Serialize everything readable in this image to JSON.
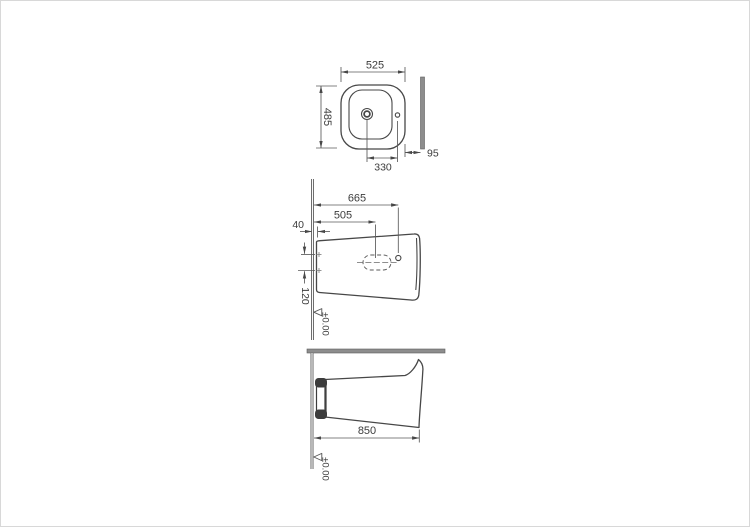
{
  "plan": {
    "width": "525",
    "depth": "485",
    "drain_to_tap_hole": "330",
    "wall_gap": "95"
  },
  "side": {
    "tap_hole_height": "665",
    "opening_height": "505",
    "base_inset": "40",
    "fixing_spacing": "120",
    "floor_level": "±0.00"
  },
  "install": {
    "overall_height": "850",
    "floor_level": "±0.00"
  },
  "colors": {
    "line": "#474747",
    "wall_fill": "#8d8d8d",
    "text": "#3c3c3c",
    "bracket": "#3c3c3c"
  }
}
